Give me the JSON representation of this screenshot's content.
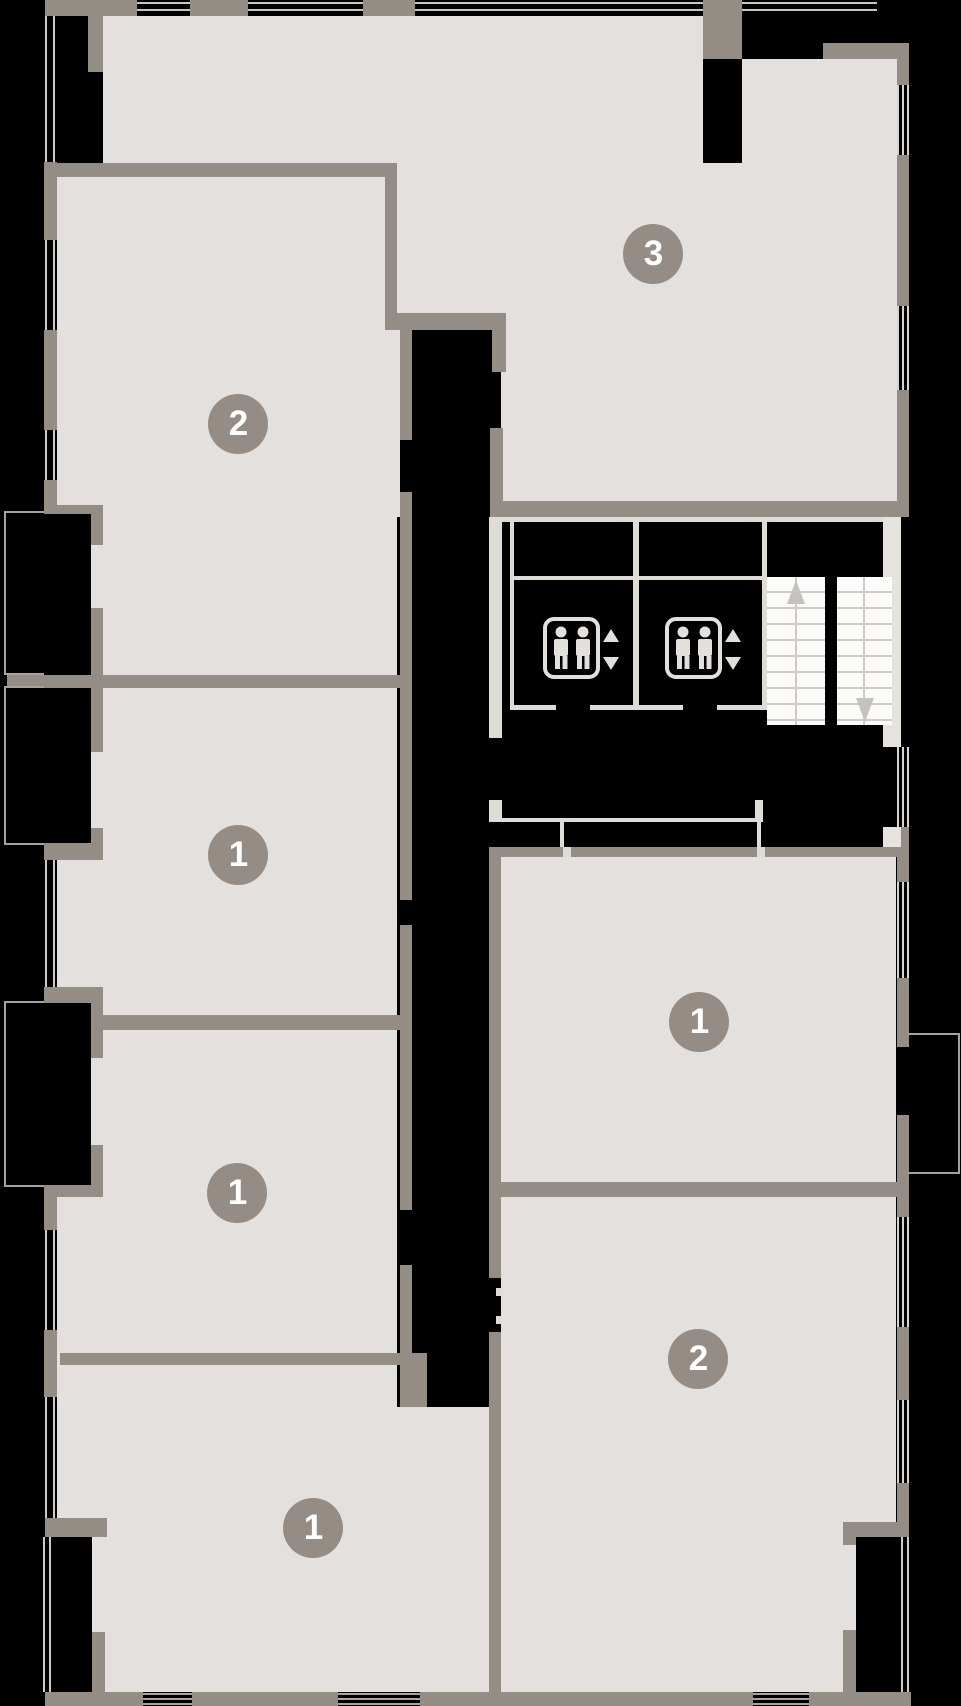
{
  "plan": {
    "title": "Apartment floor plan",
    "units": [
      {
        "name": "unit-3",
        "label": "3"
      },
      {
        "name": "unit-2-left",
        "label": "2"
      },
      {
        "name": "unit-1-left-upper",
        "label": "1"
      },
      {
        "name": "unit-1-right",
        "label": "1"
      },
      {
        "name": "unit-1-left-lower",
        "label": "1"
      },
      {
        "name": "unit-2-right",
        "label": "2"
      },
      {
        "name": "unit-1-bottom",
        "label": "1"
      }
    ],
    "core": {
      "elevators": [
        {
          "name": "elevator-left",
          "icon": "elevator-passengers-icon",
          "controls": [
            "up-arrow",
            "down-arrow"
          ]
        },
        {
          "name": "elevator-right",
          "icon": "elevator-passengers-icon",
          "controls": [
            "up-arrow",
            "down-arrow"
          ]
        }
      ],
      "stairs": {
        "flights": 2,
        "up_arrow": "left-flight-top",
        "down_arrow": "right-flight-bottom"
      }
    },
    "colors": {
      "background": "#000000",
      "room_fill": "#e3e0dd",
      "wall": "#948d85",
      "badge": "#958d85",
      "badge_text": "#ffffff",
      "stairs_fill": "#fbfbfa",
      "tread_line": "#cfccc7",
      "window_line": "#d7d3cf"
    }
  }
}
